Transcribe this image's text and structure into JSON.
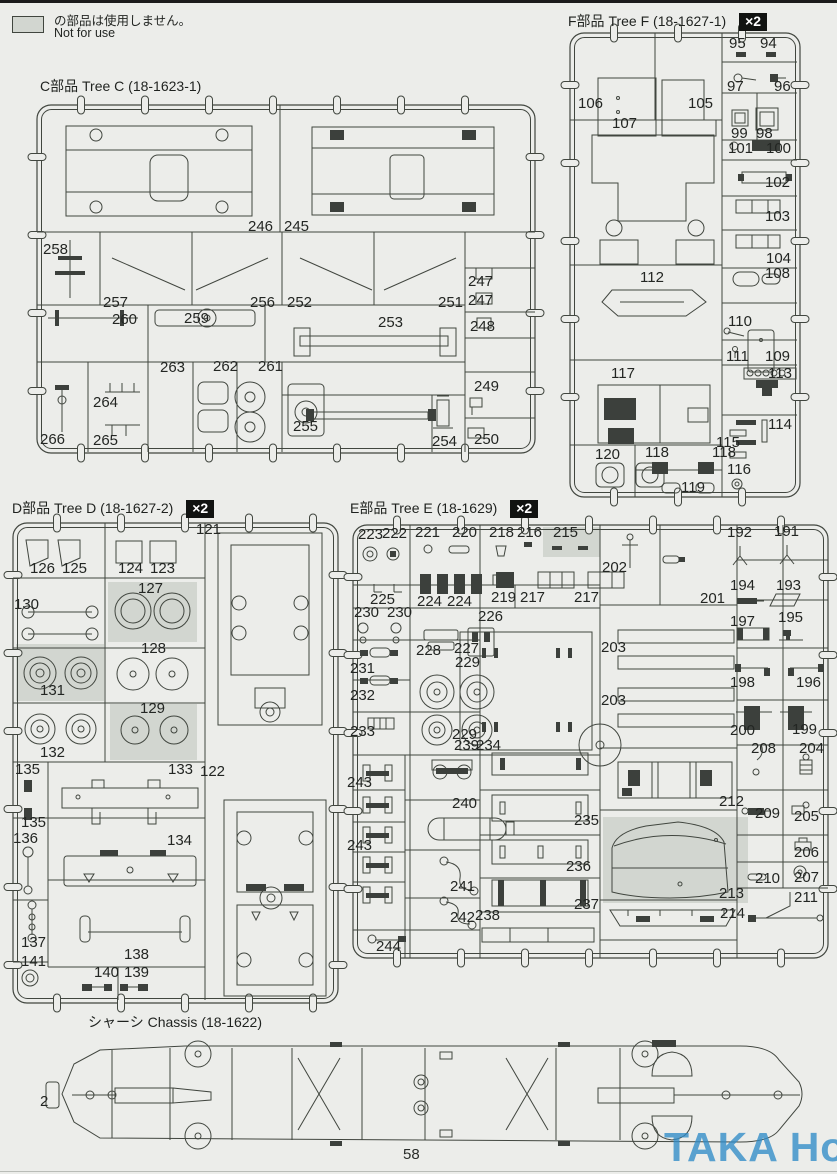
{
  "page": {
    "number": "58",
    "watermark": "TAKA Hobby"
  },
  "legend": {
    "jp": "の部品は使用しません。",
    "en": "Not for use"
  },
  "sections": [
    {
      "id": "tree-c",
      "title": "C部品 Tree C (18-1623-1)",
      "multiplier": "",
      "parts": [
        {
          "n": "246",
          "x": 248,
          "y": 231
        },
        {
          "n": "245",
          "x": 284,
          "y": 231
        },
        {
          "n": "258",
          "x": 43,
          "y": 254
        },
        {
          "n": "257",
          "x": 103,
          "y": 307
        },
        {
          "n": "256",
          "x": 250,
          "y": 307
        },
        {
          "n": "252",
          "x": 287,
          "y": 307
        },
        {
          "n": "251",
          "x": 438,
          "y": 307
        },
        {
          "n": "247",
          "x": 468,
          "y": 286
        },
        {
          "n": "247",
          "x": 468,
          "y": 305
        },
        {
          "n": "248",
          "x": 470,
          "y": 331
        },
        {
          "n": "260",
          "x": 112,
          "y": 324
        },
        {
          "n": "259",
          "x": 184,
          "y": 323
        },
        {
          "n": "253",
          "x": 378,
          "y": 327
        },
        {
          "n": "263",
          "x": 160,
          "y": 372
        },
        {
          "n": "262",
          "x": 213,
          "y": 371
        },
        {
          "n": "261",
          "x": 258,
          "y": 371
        },
        {
          "n": "264",
          "x": 93,
          "y": 407
        },
        {
          "n": "265",
          "x": 93,
          "y": 445
        },
        {
          "n": "266",
          "x": 40,
          "y": 444
        },
        {
          "n": "255",
          "x": 293,
          "y": 431
        },
        {
          "n": "254",
          "x": 432,
          "y": 446
        },
        {
          "n": "249",
          "x": 474,
          "y": 391
        },
        {
          "n": "250",
          "x": 474,
          "y": 444
        }
      ]
    },
    {
      "id": "tree-f",
      "title": "F部品 Tree F (18-1627-1)",
      "multiplier": "×2",
      "parts": [
        {
          "n": "95",
          "x": 729,
          "y": 48
        },
        {
          "n": "94",
          "x": 760,
          "y": 48
        },
        {
          "n": "97",
          "x": 727,
          "y": 91
        },
        {
          "n": "96",
          "x": 774,
          "y": 91
        },
        {
          "n": "106",
          "x": 578,
          "y": 108
        },
        {
          "n": "105",
          "x": 688,
          "y": 108
        },
        {
          "n": "107",
          "x": 612,
          "y": 128
        },
        {
          "n": "99",
          "x": 731,
          "y": 138
        },
        {
          "n": "98",
          "x": 756,
          "y": 138
        },
        {
          "n": "101",
          "x": 728,
          "y": 153
        },
        {
          "n": "100",
          "x": 766,
          "y": 153
        },
        {
          "n": "102",
          "x": 765,
          "y": 187
        },
        {
          "n": "103",
          "x": 765,
          "y": 221
        },
        {
          "n": "104",
          "x": 766,
          "y": 263
        },
        {
          "n": "108",
          "x": 765,
          "y": 278
        },
        {
          "n": "112",
          "x": 640,
          "y": 282
        },
        {
          "n": "110",
          "x": 728,
          "y": 326
        },
        {
          "n": "111",
          "x": 726,
          "y": 361
        },
        {
          "n": "109",
          "x": 765,
          "y": 361
        },
        {
          "n": "113",
          "x": 768,
          "y": 378
        },
        {
          "n": "117",
          "x": 611,
          "y": 378
        },
        {
          "n": "114",
          "x": 768,
          "y": 429
        },
        {
          "n": "115",
          "x": 716,
          "y": 447
        },
        {
          "n": "120",
          "x": 595,
          "y": 459
        },
        {
          "n": "118",
          "x": 645,
          "y": 457
        },
        {
          "n": "118",
          "x": 712,
          "y": 457
        },
        {
          "n": "119",
          "x": 681,
          "y": 492
        },
        {
          "n": "116",
          "x": 727,
          "y": 474
        }
      ]
    },
    {
      "id": "tree-d",
      "title": "D部品 Tree D (18-1627-2)",
      "multiplier": "×2",
      "parts": [
        {
          "n": "126",
          "x": 30,
          "y": 573
        },
        {
          "n": "125",
          "x": 62,
          "y": 573
        },
        {
          "n": "124",
          "x": 118,
          "y": 573
        },
        {
          "n": "123",
          "x": 150,
          "y": 573
        },
        {
          "n": "121",
          "x": 196,
          "y": 534
        },
        {
          "n": "130",
          "x": 14,
          "y": 609
        },
        {
          "n": "127",
          "x": 138,
          "y": 593
        },
        {
          "n": "131",
          "x": 40,
          "y": 695
        },
        {
          "n": "128",
          "x": 141,
          "y": 653
        },
        {
          "n": "129",
          "x": 140,
          "y": 713
        },
        {
          "n": "132",
          "x": 40,
          "y": 757
        },
        {
          "n": "135",
          "x": 15,
          "y": 774
        },
        {
          "n": "133",
          "x": 168,
          "y": 774
        },
        {
          "n": "122",
          "x": 200,
          "y": 776
        },
        {
          "n": "135",
          "x": 21,
          "y": 827
        },
        {
          "n": "136",
          "x": 13,
          "y": 843
        },
        {
          "n": "134",
          "x": 167,
          "y": 845
        },
        {
          "n": "137",
          "x": 21,
          "y": 947
        },
        {
          "n": "138",
          "x": 124,
          "y": 959
        },
        {
          "n": "141",
          "x": 21,
          "y": 966
        },
        {
          "n": "140",
          "x": 94,
          "y": 977
        },
        {
          "n": "139",
          "x": 124,
          "y": 977
        }
      ]
    },
    {
      "id": "tree-e",
      "title": "E部品 Tree E (18-1629)",
      "multiplier": "×2",
      "parts": [
        {
          "n": "223",
          "x": 358,
          "y": 539
        },
        {
          "n": "222",
          "x": 382,
          "y": 538
        },
        {
          "n": "221",
          "x": 415,
          "y": 537
        },
        {
          "n": "220",
          "x": 452,
          "y": 537
        },
        {
          "n": "218",
          "x": 489,
          "y": 537
        },
        {
          "n": "216",
          "x": 517,
          "y": 537
        },
        {
          "n": "215",
          "x": 553,
          "y": 537
        },
        {
          "n": "192",
          "x": 727,
          "y": 537
        },
        {
          "n": "191",
          "x": 774,
          "y": 536
        },
        {
          "n": "202",
          "x": 602,
          "y": 572
        },
        {
          "n": "201",
          "x": 700,
          "y": 603
        },
        {
          "n": "225",
          "x": 370,
          "y": 604
        },
        {
          "n": "224",
          "x": 417,
          "y": 606
        },
        {
          "n": "224",
          "x": 447,
          "y": 606
        },
        {
          "n": "219",
          "x": 491,
          "y": 602
        },
        {
          "n": "217",
          "x": 520,
          "y": 602
        },
        {
          "n": "217",
          "x": 574,
          "y": 602
        },
        {
          "n": "194",
          "x": 730,
          "y": 590
        },
        {
          "n": "193",
          "x": 776,
          "y": 590
        },
        {
          "n": "230",
          "x": 354,
          "y": 617
        },
        {
          "n": "230",
          "x": 387,
          "y": 617
        },
        {
          "n": "226",
          "x": 478,
          "y": 621
        },
        {
          "n": "197",
          "x": 730,
          "y": 626
        },
        {
          "n": "195",
          "x": 778,
          "y": 622
        },
        {
          "n": "228",
          "x": 416,
          "y": 655
        },
        {
          "n": "227",
          "x": 454,
          "y": 653
        },
        {
          "n": "229",
          "x": 455,
          "y": 667
        },
        {
          "n": "203",
          "x": 601,
          "y": 652
        },
        {
          "n": "203",
          "x": 601,
          "y": 705
        },
        {
          "n": "231",
          "x": 350,
          "y": 673
        },
        {
          "n": "232",
          "x": 350,
          "y": 700
        },
        {
          "n": "233",
          "x": 350,
          "y": 736
        },
        {
          "n": "198",
          "x": 730,
          "y": 687
        },
        {
          "n": "196",
          "x": 796,
          "y": 687
        },
        {
          "n": "229",
          "x": 452,
          "y": 739
        },
        {
          "n": "239",
          "x": 454,
          "y": 750
        },
        {
          "n": "234",
          "x": 476,
          "y": 750
        },
        {
          "n": "200",
          "x": 730,
          "y": 735
        },
        {
          "n": "199",
          "x": 792,
          "y": 734
        },
        {
          "n": "208",
          "x": 751,
          "y": 753
        },
        {
          "n": "204",
          "x": 799,
          "y": 753
        },
        {
          "n": "243",
          "x": 347,
          "y": 787
        },
        {
          "n": "243",
          "x": 347,
          "y": 850
        },
        {
          "n": "240",
          "x": 452,
          "y": 808
        },
        {
          "n": "212",
          "x": 719,
          "y": 806
        },
        {
          "n": "209",
          "x": 755,
          "y": 818
        },
        {
          "n": "205",
          "x": 794,
          "y": 821
        },
        {
          "n": "235",
          "x": 574,
          "y": 825
        },
        {
          "n": "236",
          "x": 566,
          "y": 871
        },
        {
          "n": "206",
          "x": 794,
          "y": 857
        },
        {
          "n": "241",
          "x": 450,
          "y": 891
        },
        {
          "n": "210",
          "x": 755,
          "y": 883
        },
        {
          "n": "207",
          "x": 794,
          "y": 882
        },
        {
          "n": "242",
          "x": 450,
          "y": 922
        },
        {
          "n": "238",
          "x": 475,
          "y": 920
        },
        {
          "n": "237",
          "x": 574,
          "y": 909
        },
        {
          "n": "213",
          "x": 719,
          "y": 898
        },
        {
          "n": "211",
          "x": 794,
          "y": 902
        },
        {
          "n": "214",
          "x": 720,
          "y": 918
        },
        {
          "n": "244",
          "x": 376,
          "y": 951
        }
      ]
    },
    {
      "id": "chassis",
      "title": "シャーシ Chassis (18-1622)",
      "multiplier": "",
      "parts": [
        {
          "n": "2",
          "x": 40,
          "y": 1106
        }
      ]
    }
  ],
  "not_for_use_parts": [
    "127",
    "131",
    "129",
    "215",
    "213"
  ],
  "colors": {
    "line": "#41463f",
    "text": "#232623",
    "gray_fill": "#d2d6d0",
    "badge_bg": "#111311",
    "badge_text": "#ffffff",
    "watermark": "#3f98cd",
    "page_bg": "#ecedea"
  }
}
